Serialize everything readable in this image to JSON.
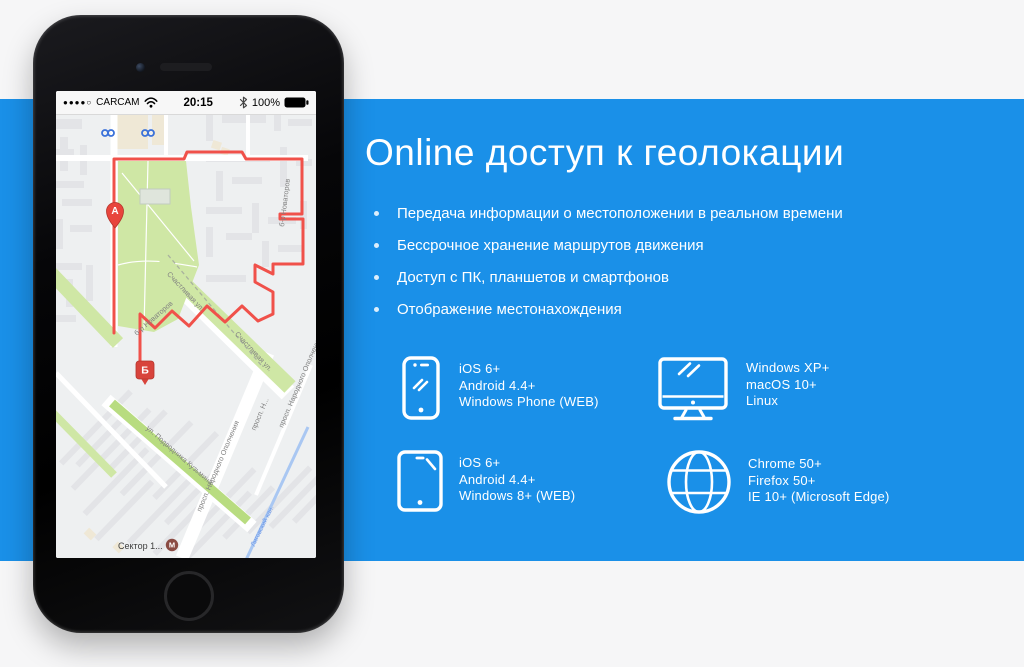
{
  "colors": {
    "band": "#1a90e8",
    "page_bg": "#f6f6f7",
    "route_red": "#f0514a"
  },
  "headline": "Online доступ к геолокации",
  "bullets": [
    "Передача информации о местоположении в реальном времени",
    "Бессрочное хранение маршрутов движения",
    "Доступ с ПК, планшетов и смартфонов",
    "Отображение местонахождения"
  ],
  "features": [
    {
      "name": "mobile",
      "lines": [
        "iOS 6+",
        "Android 4.4+",
        "Windows Phone (WEB)"
      ]
    },
    {
      "name": "desktop",
      "lines": [
        "Windows XP+",
        "macOS 10+",
        "Linux"
      ]
    },
    {
      "name": "tablet",
      "lines": [
        "iOS 6+",
        "Android 4.4+",
        "Windows 8+ (WEB)"
      ]
    },
    {
      "name": "browser",
      "lines": [
        "Chrome 50+",
        "Firefox 50+",
        "IE 10+ (Microsoft Edge)"
      ]
    }
  ],
  "phone": {
    "status": {
      "signal": "●●●●○",
      "carrier": "CARCAM",
      "time": "20:15",
      "battery_pct": "100%"
    },
    "map": {
      "marker_a": "А",
      "marker_b": "Б",
      "metro": "М",
      "labels": {
        "novatorov": "б-р Новаторов",
        "schastlivaya": "Счастливая ул.",
        "podvodnika": "ул. Подводника Кузьмина",
        "narodnogo": "просп. Народного Ополчения",
        "prosp_n": "просп. Н...",
        "ligovsky": "Лиговский кан.",
        "sektor": "Сектор 1..."
      }
    }
  }
}
